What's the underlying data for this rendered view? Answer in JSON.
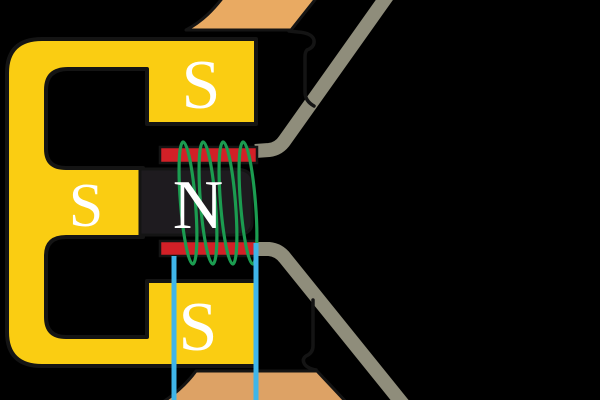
{
  "diagram": {
    "type": "loudspeaker-driver-cross-section",
    "labels": {
      "top_pole": "S",
      "middle_pole": "S",
      "bottom_pole": "S",
      "center_pole": "N"
    }
  },
  "colors": {
    "background": "#000000",
    "magnet_yellow": "#FACD12",
    "pole_black": "#1E1B1F",
    "outline": "#141414",
    "coil_former_red": "#D22027",
    "coil_wire_green": "#1B9C50",
    "lead_wire_blue": "#3FB5E9",
    "cone_gray": "#8F8D7B",
    "surround_tan": "#E9AA62",
    "surround_tan_bottom": "#DDA265",
    "label_white": "#FFFFFF"
  }
}
